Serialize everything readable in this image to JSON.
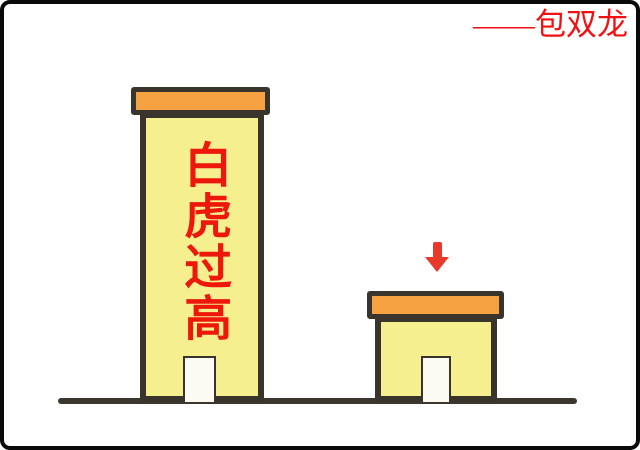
{
  "signature": {
    "text": "——包双龙",
    "color": "#f21010"
  },
  "diagram": {
    "tall_building": {
      "label": "白虎过高",
      "label_color": "#ed170b",
      "roof_color": "#f6a242",
      "wall_color": "#f5ef8f",
      "outline_color": "#3a352c",
      "door_color": "#fbfbf4"
    },
    "short_building": {
      "label": "",
      "roof_color": "#f6a242",
      "wall_color": "#f5ef8f",
      "outline_color": "#3a352c",
      "door_color": "#fbfbf4"
    },
    "arrow": {
      "direction": "down",
      "color": "#e8392b"
    },
    "ground": {
      "color": "#3b372f"
    },
    "frame": {
      "color": "#0a0a0a"
    },
    "background_color": "#ffffff"
  }
}
